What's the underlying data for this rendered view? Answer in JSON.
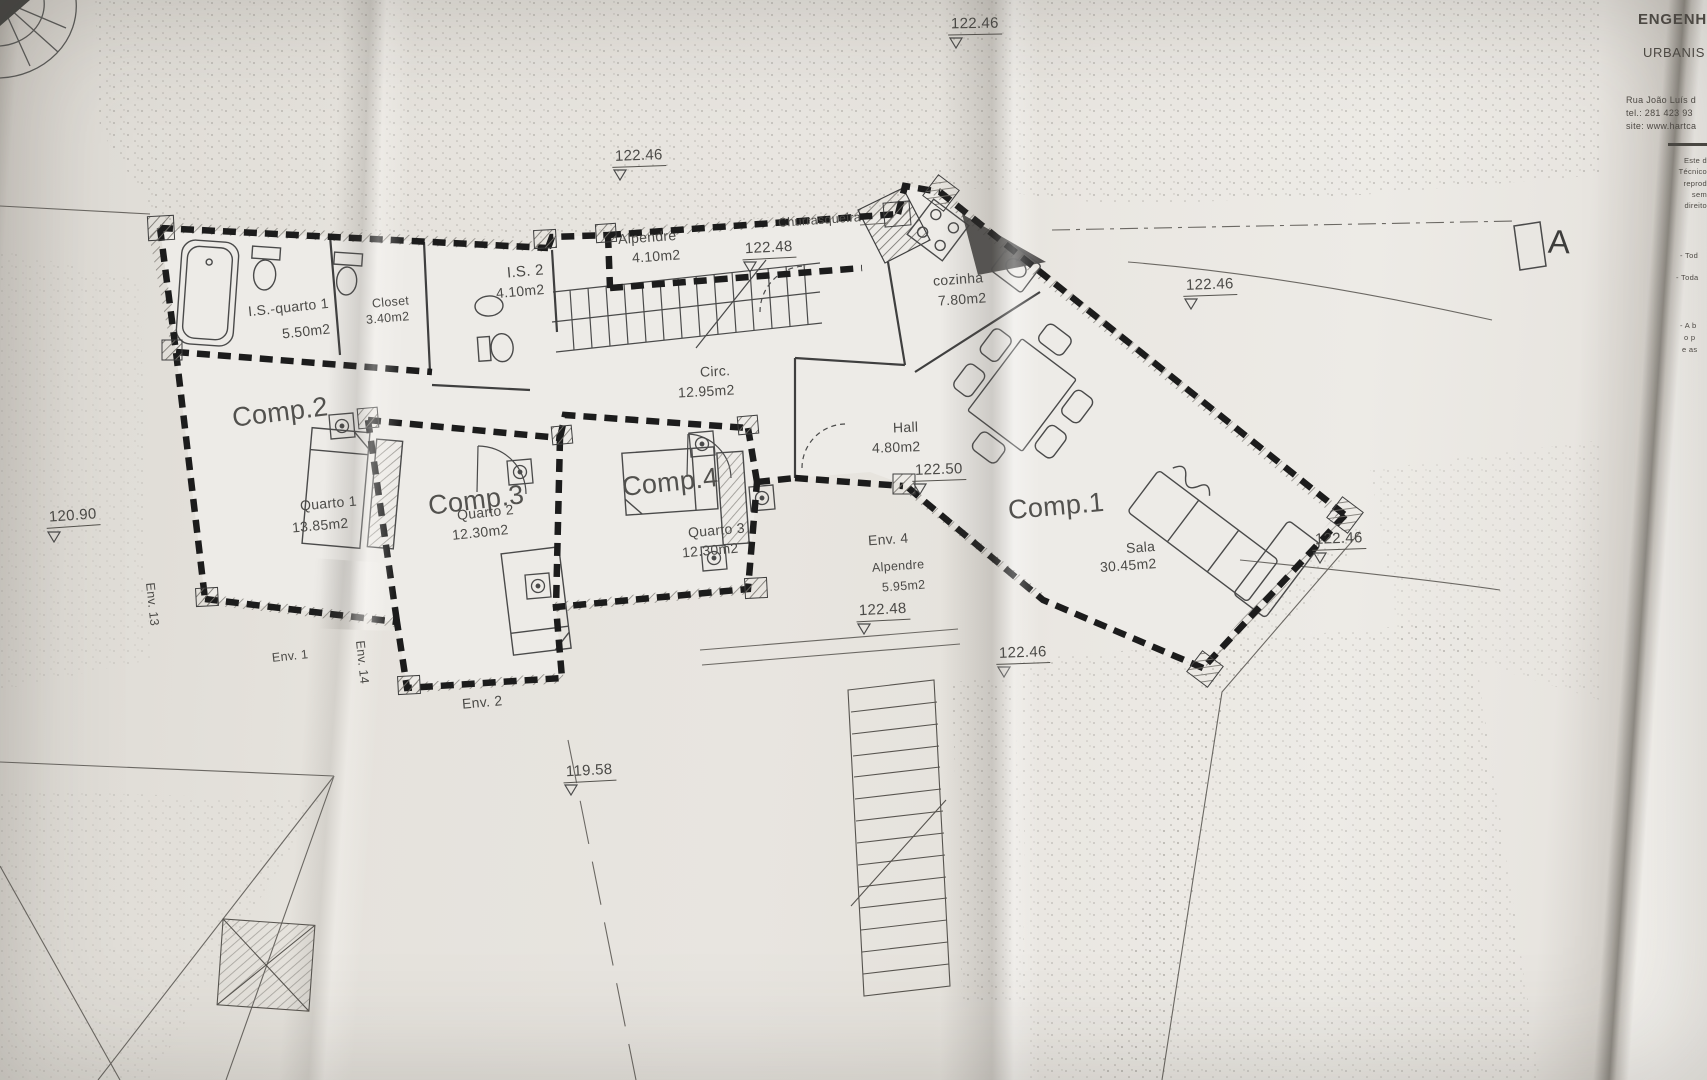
{
  "titleblock": {
    "company_line1": "ENGENHA",
    "company_line2": "URBANIS",
    "contact": [
      "Rua João Luís d",
      "tel.: 281 423 93",
      "site: www.hartca"
    ],
    "disclaimer": [
      "Este d",
      "Técnico",
      "reprod",
      "sem",
      "direito"
    ],
    "notes": [
      "- Tod",
      "- Toda",
      "- A b",
      "o p",
      "e as"
    ]
  },
  "section_marker": "A",
  "rooms": {
    "alpendre_top": {
      "name": "Alpendre",
      "area": "4.10m2"
    },
    "churrasqueira": {
      "name": "Churrasqueira"
    },
    "is2": {
      "name": "I.S. 2",
      "area": "4.10m2"
    },
    "closet": {
      "name": "Closet",
      "area": "3.40m2"
    },
    "is_quarto1": {
      "name": "I.S.-quarto 1",
      "area": "5.50m2"
    },
    "circ": {
      "name": "Circ.",
      "area": "12.95m2"
    },
    "cozinha": {
      "name": "cozinha",
      "area": "7.80m2"
    },
    "hall": {
      "name": "Hall",
      "area": "4.80m2"
    },
    "comp1": {
      "label": "Comp.1",
      "name": "Sala",
      "area": "30.45m2"
    },
    "comp2": {
      "label": "Comp.2",
      "name": "Quarto 1",
      "area": "13.85m2"
    },
    "comp3": {
      "label": "Comp.3",
      "name": "Quarto 2",
      "area": "12.30m2"
    },
    "comp4": {
      "label": "Comp.4",
      "name": "Quarto 3",
      "area": "12.30m2"
    },
    "env4": {
      "label": "Env. 4",
      "name": "Alpendre",
      "area": "5.95m2"
    }
  },
  "envelopes": {
    "env13": "Env. 13",
    "env1": "Env. 1",
    "env14": "Env. 14",
    "env2": "Env. 2"
  },
  "elevations": [
    "122.46",
    "122.46",
    "122.48",
    "122.46",
    "122.50",
    "122.48",
    "119.58",
    "120.90",
    "122.46",
    "122.46"
  ]
}
